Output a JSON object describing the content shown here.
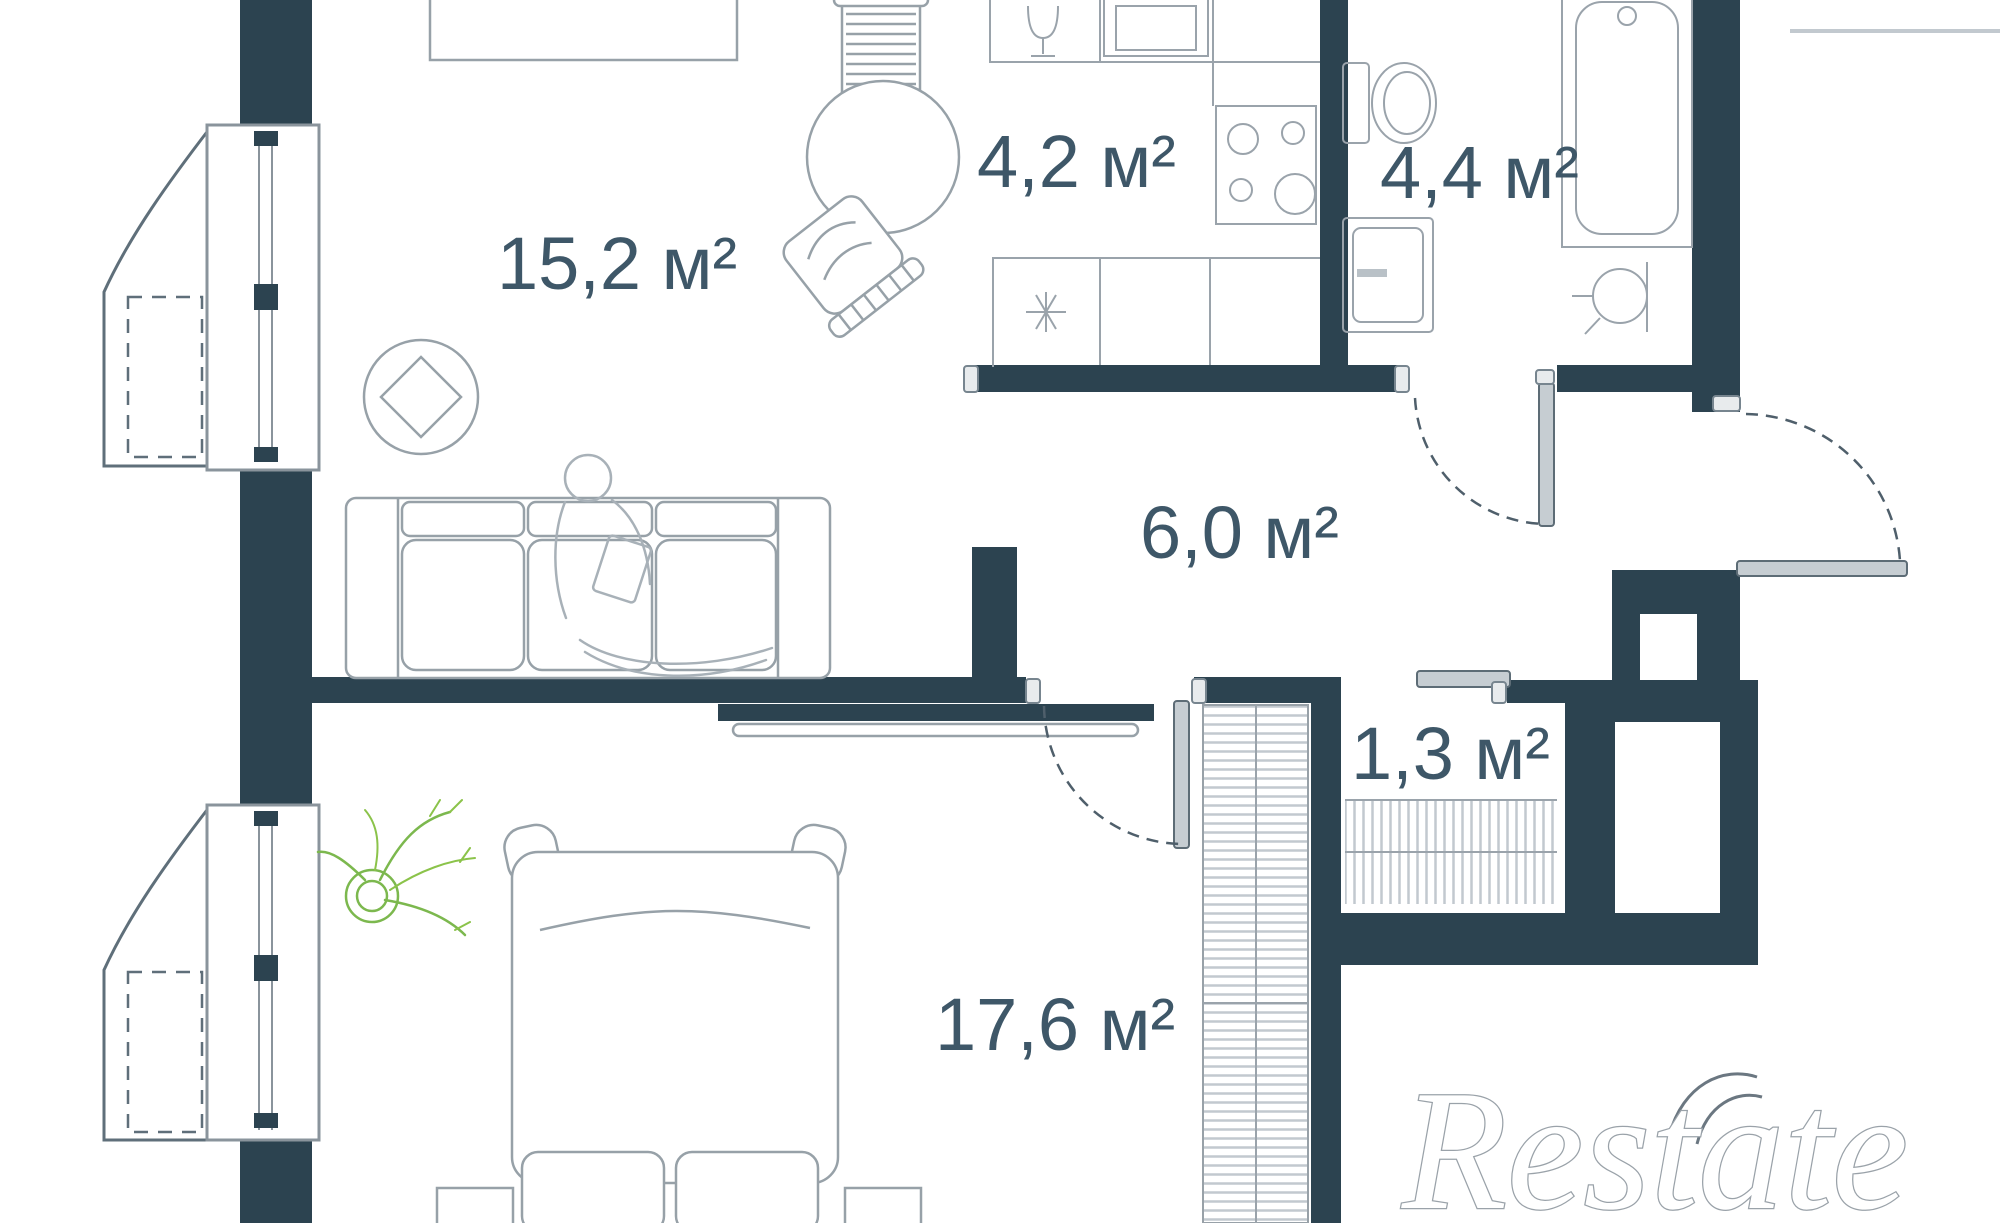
{
  "plan": {
    "type": "apartment-floor-plan",
    "watermark": "Restate",
    "rooms": [
      {
        "name": "living-room",
        "area_label": "15,2 м²"
      },
      {
        "name": "kitchen",
        "area_label": "4,2 м²"
      },
      {
        "name": "bathroom",
        "area_label": "4,4 м²"
      },
      {
        "name": "hallway",
        "area_label": "6,0 м²"
      },
      {
        "name": "closet",
        "area_label": "1,3 м²"
      },
      {
        "name": "bedroom",
        "area_label": "17,6 м²"
      }
    ],
    "fixtures": [
      "sofa",
      "tv",
      "rug",
      "round-table",
      "chairs",
      "desk",
      "plant",
      "bed",
      "nightstands",
      "wardrobe",
      "closet-rail",
      "kitchen-sink",
      "stove",
      "fridge",
      "toilet",
      "washing-machine",
      "bathtub",
      "washbasin",
      "balcony-upper",
      "balcony-lower"
    ],
    "colors": {
      "wall": "#2c4350",
      "furniture_line": "#97a1a8",
      "label": "#3e5768",
      "plant": "#7cb84e",
      "door_leaf": "#c6cdd2",
      "balcony_line": "#5f6f7a",
      "background": "#ffffff"
    }
  }
}
